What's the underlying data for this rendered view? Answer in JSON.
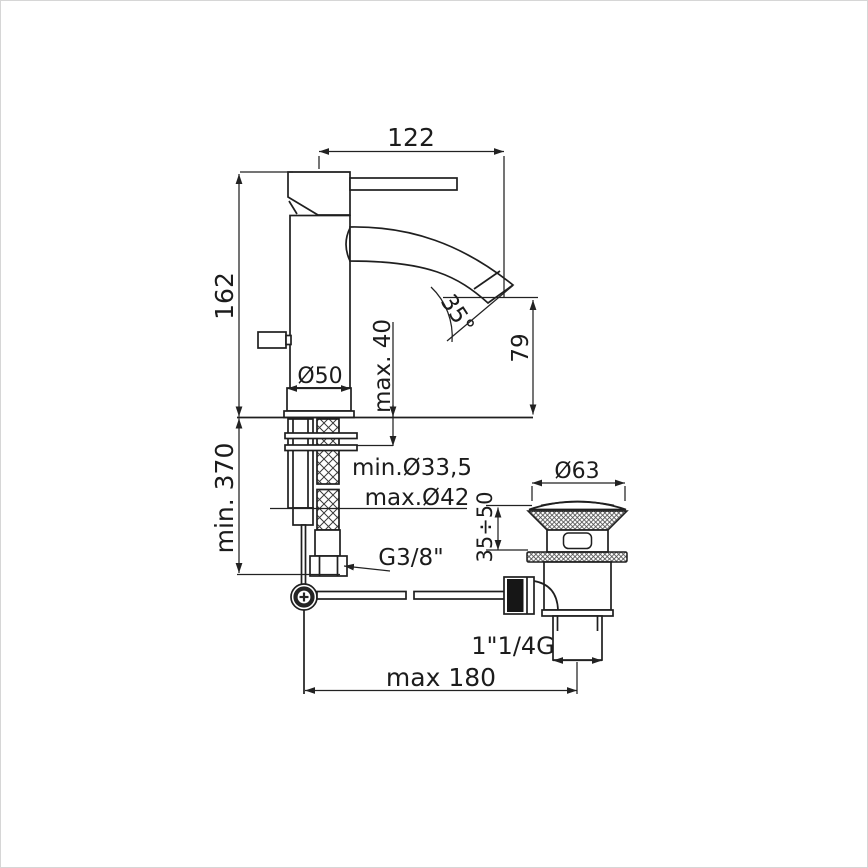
{
  "drawing": {
    "type": "technical-dimension-drawing",
    "subject": "single-lever basin mixer with pop-up waste",
    "background": "#ffffff",
    "line_color": "#1f1f1f",
    "labels": {
      "spout_reach": "122",
      "height_above_deck": "162",
      "max_deck_thickness": "max. 40",
      "spout_angle": "35°",
      "spout_outlet_height": "79",
      "base_diameter": "Ø50",
      "min_supply_length": "min. 370",
      "min_hole_diameter": "min.Ø33,5",
      "max_hole_diameter": "max.Ø42",
      "supply_thread": "G3/8\"",
      "waste_cap_diameter": "Ø63",
      "waste_clamp_range": "35÷50",
      "waste_thread": "1\"1/4G",
      "max_rod_reach": "max 180"
    }
  }
}
